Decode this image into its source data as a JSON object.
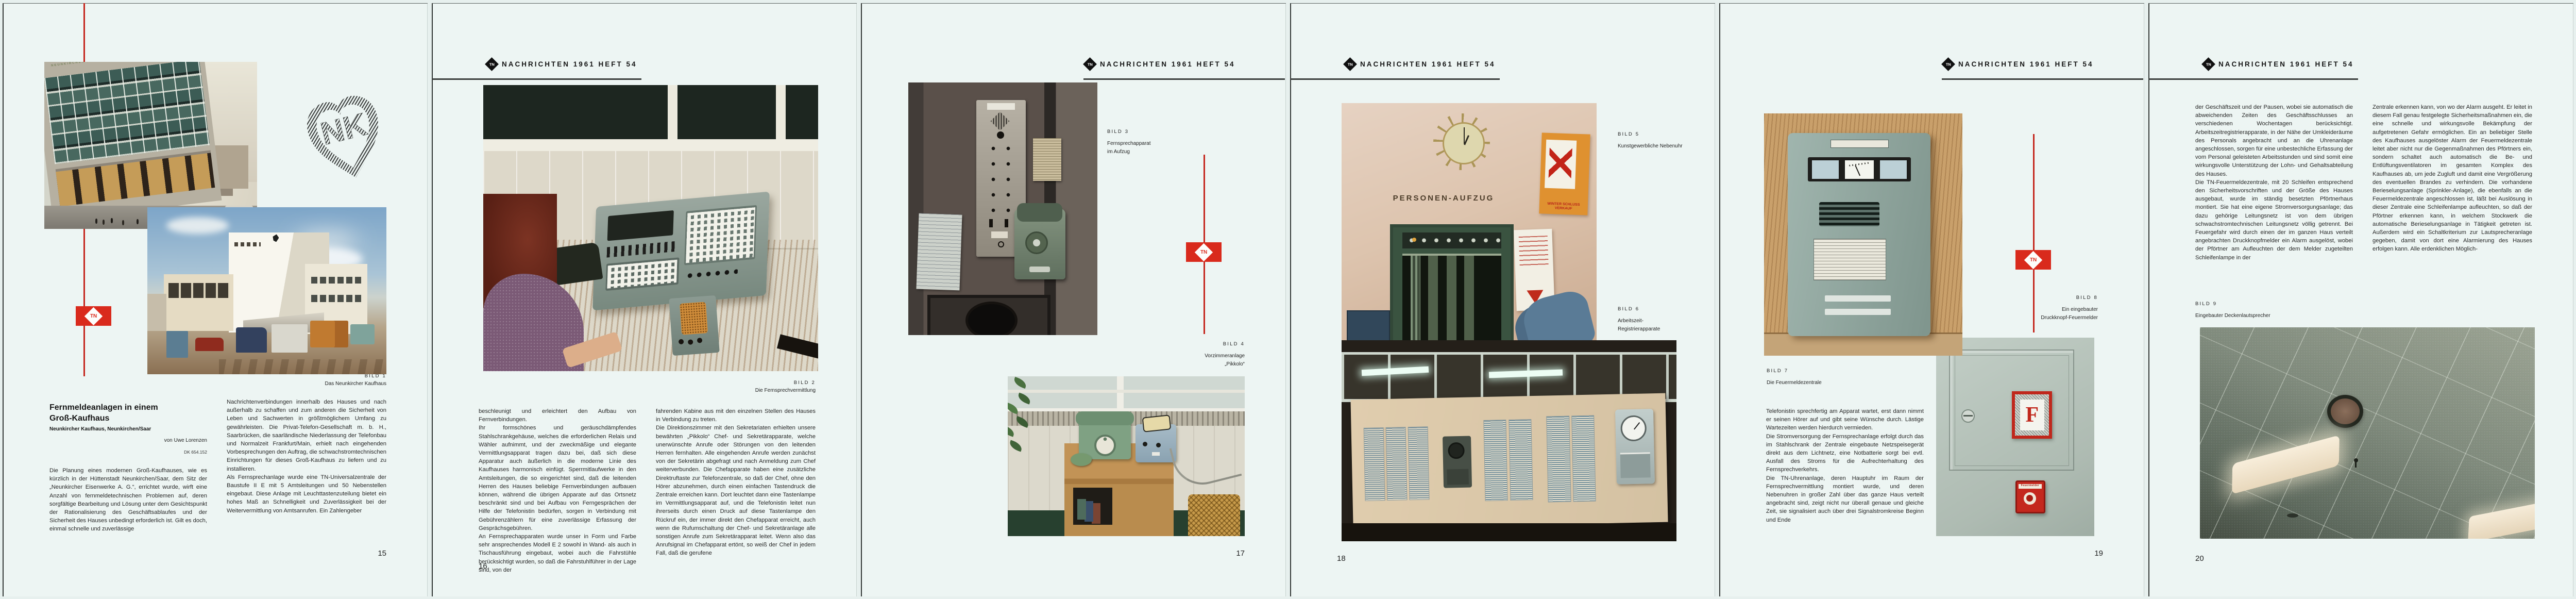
{
  "publication": {
    "header": "NACHRICHTEN 1961 HEFT 54",
    "logo_monogram": "TN",
    "accent_red": "#c4251c",
    "paper_color": "#edf5f3"
  },
  "sheets": [
    {
      "page_number": "15",
      "emblem_letters": "NK",
      "article": {
        "title_line1": "Fernmeldeanlagen in einem",
        "title_line2": "Groß-Kaufhaus",
        "subtitle": "Neunkircher Kaufhaus, Neunkirchen/Saar",
        "byline": "von Uwe Lorenzen",
        "dk": "DK 654.152"
      },
      "captions": {
        "bild1": {
          "label": "BILD 1",
          "line": "Das Neunkircher Kaufhaus"
        }
      },
      "photo_texts": {
        "roof_sign": "NEUNKIRCHER KAUFHAUS"
      },
      "columns": {
        "left": [
          "Die Planung eines modernen Groß-Kaufhauses, wie es kürzlich in der Hüttenstadt Neunkirchen/Saar, dem Sitz der „Neunkircher Eisenwerke A. G.“, errichtet wurde, wirft eine Anzahl von fernmeldetechnischen Problemen auf, deren sorgfältige Bearbeitung und Lösung unter dem Gesichtspunkt der Rationalisierung des Geschäftsablaufes und der Sicherheit des Hauses unbedingt erforderlich ist. Gilt es doch, einmal schnelle und zuverlässige"
        ],
        "right": [
          "Nachrichtenverbindungen innerhalb des Hauses und nach außerhalb zu schaffen und zum anderen die Sicherheit von Leben und Sachwerten in größtmöglichem Umfang zu gewährleisten. Die Privat-Telefon-Gesellschaft m. b. H., Saarbrücken, die saarländische Niederlassung der Telefonbau und Normalzeit Frankfurt/Main, erhielt nach eingehenden Vorbesprechungen den Auftrag, die schwachstromtechnischen Einrichtungen für dieses Groß-Kaufhaus zu liefern und zu installieren.",
          "Als Fernsprechanlage wurde eine TN-Universalzentrale der Baustufe II E mit 5 Amtsleitungen und 50 Nebenstellen eingebaut. Diese Anlage mit Leuchttastenzuteilung bietet ein hohes Maß an Schnelligkeit und Zuverlässigkeit bei der Weitervermittlung von Amtsanrufen. Ein Zahlengeber"
        ]
      }
    },
    {
      "page_number": "16",
      "captions": {
        "bild2": {
          "label": "BILD 2",
          "line": "Die Fernsprechvermittlung"
        }
      },
      "columns": {
        "left": [
          "beschleunigt und erleichtert den Aufbau von Fernverbindungen.",
          "Ihr formschönes und geräuschdämpfendes Stahlschrankgehäuse, welches die erforderlichen Relais und Wähler aufnimmt, und der zweckmäßige und elegante Vermittlungsapparat tragen dazu bei, daß sich diese Apparatur auch äußerlich in die moderne Linie des Kaufhauses harmonisch einfügt. Sperrmitlaufwerke in den Amtsleitungen, die so eingerichtet sind, daß die leitenden Herren des Hauses beliebige Fernverbindungen aufbauen können, während die übrigen Apparate auf das Ortsnetz beschränkt sind und bei Aufbau von Ferngesprächen der Hilfe der Telefonistin bedürfen, sorgen in Verbindung mit Gebührenzählern für eine zuverlässige Erfassung der Gesprächsgebühren.",
          "An Fernsprechapparaten wurde unser in Form und Farbe sehr ansprechendes Modell E 2 sowohl in Wand- als auch in Tischausführung eingebaut, wobei auch die Fahrstühle berücksichtigt wurden, so daß die Fahrstuhlführer in der Lage sind, von der"
        ],
        "right": [
          "fahrenden Kabine aus mit den einzelnen Stellen des Hauses in Verbindung zu treten.",
          "Die Direktionszimmer mit den Sekretariaten erhielten unsere bewährten „Pikkolo“ Chef- und Sekretärapparate, welche unerwünschte Anrufe oder Störungen von den leitenden Herren fernhalten. Alle eingehenden Anrufe werden zunächst von der Sekretärin abgefragt und nach Anmeldung zum Chef weiterverbunden. Die Chefapparate haben eine zusätzliche Direktruftaste zur Telefonzentrale, so daß der Chef, ohne den Hörer abzunehmen, durch einen einfachen Tastendruck die Zentrale erreichen kann. Dort leuchtet dann eine Tastenlampe im Vermittlungsapparat auf, und die Telefonistin leitet nun ihrerseits durch einen Druck auf diese Tastenlampe den Rückruf ein, der immer direkt den Chefapparat erreicht, auch wenn die Rufumschaltung der Chef- und Sekretäranlage alle sonstigen Anrufe zum Sekretärapparat leitet. Wenn also das Anrufsignal im Chefapparat ertönt, so weiß der Chef in jedem Fall, daß die gerufene"
        ]
      }
    },
    {
      "page_number": "17",
      "captions": {
        "bild3": {
          "label": "BILD 3",
          "lines": [
            "Fernsprechapparat",
            "im Aufzug"
          ]
        },
        "bild4": {
          "label": "BILD 4",
          "lines": [
            "Vorzimmeranlage",
            "„Pikkolo“"
          ]
        }
      }
    },
    {
      "page_number": "18",
      "captions": {
        "bild5": {
          "label": "BILD 5",
          "lines": [
            "Kunstgewerbliche Nebenuhr"
          ]
        },
        "bild6": {
          "label": "BILD 6",
          "lines": [
            "Arbeitszeit-",
            "Registrierapparate"
          ]
        }
      },
      "photo_texts": {
        "aufzug_sign": "PERSONEN-AUFZUG",
        "poster": "WINTER SCHLUSS VERKAUF"
      }
    },
    {
      "page_number": "19",
      "captions": {
        "bild7": {
          "label": "BILD 7",
          "lines": [
            "Die Feuermeldezentrale"
          ]
        },
        "bild8": {
          "label": "BILD 8",
          "lines": [
            "Ein eingebauter",
            "Druckknopf-Feuermelder"
          ]
        }
      },
      "photo_texts": {
        "f": "F",
        "melder": "Feuermelder"
      },
      "columns": {
        "left": [
          "Telefonistin sprechfertig am Apparat wartet, erst dann nimmt er seinen Hörer auf und gibt seine Wünsche durch. Lästige Wartezeiten werden hierdurch vermieden.",
          "Die Stromversorgung der Fernsprechanlage erfolgt durch das im Stahlschrank der Zentrale eingebaute Netzspeisegerät direkt aus dem Lichtnetz, eine Notbatterie sorgt bei evtl. Ausfall des Stroms für die Aufrechterhaltung des Fernsprechverkehrs.",
          "Die TN-Uhrenanlage, deren Hauptuhr im Raum der Fernsprechvermittlung montiert wurde, und deren Nebenuhren in großer Zahl über das ganze Haus verteilt angebracht sind, zeigt nicht nur überall genaue und gleiche Zeit, sie signalisiert auch über drei Signalstromkreise Beginn und Ende"
        ]
      }
    },
    {
      "page_number": "20",
      "captions": {
        "bild9": {
          "label": "BILD 9",
          "lines": [
            "Eingebauter Deckenlautsprecher"
          ]
        }
      },
      "columns": {
        "left": [
          "der Geschäftszeit und der Pausen, wobei sie automatisch die abweichenden Zeiten des Geschäftsschlusses an verschiedenen Wochentagen berücksichtigt. Arbeitszeitregistrierapparate, in der Nähe der Umkleideräume des Personals angebracht und an die Uhrenanlage angeschlossen, sorgen für eine unbestechliche Erfassung der vom Personal geleisteten Arbeitsstunden und sind somit eine wirkungsvolle Unterstützung der Lohn- und Gehaltsabteilung des Hauses.",
          "Die TN-Feuermeldezentrale, mit 20 Schleifen entsprechend den Sicherheitsvorschriften und der Größe des Hauses ausgebaut, wurde im ständig besetzten Pförtnerhaus montiert. Sie hat eine eigene Stromversorgungsanlage; das dazu gehörige Leitungsnetz ist von dem übrigen schwachstromtechnischen Leitungsnetz völlig getrennt. Bei Feuergefahr wird durch einen der im ganzen Haus verteilt angebrachten Druckknopfmelder ein Alarm ausgelöst, wobei der Pförtner am Aufleuchten der dem Melder zugeteilten Schleifenlampe in der"
        ],
        "right": [
          "Zentrale erkennen kann, von wo der Alarm ausgeht. Er leitet in diesem Fall genau festgelegte Sicherheitsmaßnahmen ein, die eine schnelle und wirkungsvolle Bekämpfung der aufgetretenen Gefahr ermöglichen. Ein an beliebiger Stelle des Kaufhauses ausgelöster Alarm der Feuermeldezentrale leitet aber nicht nur die Gegenmaßnahmen des Pförtners ein, sondern schaltet auch automatisch die Be- und Entlüftungsventilatoren im gesamten Komplex des Kaufhauses ab, um jede Zugluft und damit eine Vergrößerung des eventuellen Brandes zu verhindern. Die vorhandene Berieselungsanlage (Sprinkler-Anlage), die ebenfalls an die Feuermeldezentrale angeschlossen ist, läßt bei Auslösung in dieser Zentrale eine Schleifenlampe aufleuchten, so daß der Pförtner erkennen kann, in welchem Stockwerk die automatische Berieselungsanlage in Tätigkeit getreten ist. Außerdem wird ein Schaltkriterium zur Lautsprecheranlage gegeben, damit von dort eine Alarmierung des Hauses erfolgen kann. Alle erdenklichen Möglich-"
        ]
      }
    },
    {
      "page_number": "21",
      "captions": {
        "bild10": {
          "label": "BILD 10",
          "lines": [
            "Wandlautsprecher",
            "der elektro-akustischen Rufanlage"
          ]
        }
      },
      "photo_texts": {
        "exit": "Ausgang",
        "smoke": "Rauchen nicht erlaubt",
        "glass1": "NUR",
        "glass2": "NOTAUSGANG",
        "number": "297"
      },
      "columns": {
        "left": [
          "keiten wurden berücksichtigt, um die Sicherheit des Hauses, des Publikums und des Personals bei Feuergefahr zu gewährleisten.",
          "Die elektro-akustische Rufanlage, in Zusammenarbeit mit der Firma Telefunken entwickelt, ist recht umfangreich. Sie umfaßt neben der Verstärkerzentrale über 100 im Hause verteilte Lautsprecher, die z. T. in die Decken eingebaut wurden. Anschlüsse für Mikrofone in den verschiedenen Abteilungen des Hauses und die Möglichkeit, in einzelnen Abteilungen, getrennt von den anderen, Sonderprogramme mittels eines Übertragungswagens aussenden zu können, sind ebenfalls vorhanden. Mikrofone mit der Möglichkeit der Sammelschaltung (Kommandoschaltung) wurden in der Telefonzentrale und bei den leitenden Direktoren installiert. Über diese Mikrofone können alle Lautsprecher angesprochen werden, gleichgültig, ob diese in einzelnen Abteilungen abgeschaltet sind oder ein Einzelprogramm abstrahlen. Auch die von der Hauptuhr der Uhrenanlage abgegebenen"
        ],
        "right": [
          "Signale für Beginn und Ende der Geschäftszeit und der Pausen werden durch eine Gongschlageinrichtung in Verbindung mit der Verstärkerzentrale über die Lautsprecher ausgestrahlt. Auch die Signalgabe bei Fernalarm erfolgt von der Feuermeldeanlage her über die Lautsprecheranlage. In diesem Fall werden alle sonstigen Programme der elektro-akustischen Rufanlage automatisch abgeschaltet (Vorrangschaltung).",
          "An verschiedenen Stellen des Hauses, besonders jedoch in den Verkaufsabteilungen für Rundfunk- und Fernsehgeräte und in Schaufenstern können Rundfunk- und Fernsehgeräte über Spezialsteckdosen an eine umfangreiche Antennenanlage mit den Wellenbereichen Lang - Mittel - Kurz - UKW und Fernsehen angeschlossen werden, so daß die Programme einwandfrei empfangen werden können. Die Antennenverstärker wurden neben der Telefonzentrale montiert, so daß sie leicht zugänglich sind und ohne Schwierigkeit gewartet werden können."
        ]
      }
    },
    {
      "page_number": "22",
      "captions": {
        "bild11": {
          "label": "BILD 11",
          "lines": [
            "Rapidofon-Hausfernsprecher",
            "in der Kühlvitrine"
          ]
        }
      },
      "photo_texts": {
        "taps": [
          "Coca-Cola",
          "Fanta",
          "Coca-Cola"
        ]
      },
      "columns": {
        "left": [
          "Kühlvitrinen in der Lebensmittelabteilung des Kaufhauses nehmen leichtverderbliche Lebensmittel auf. Es lag nahe, hier durch eine besondere Überwachungseinrichtung ständig die Temperaturen in den Vitrinen kontrollieren zu lassen, damit Abweichungen von der vorgeschriebenen Temperaturhöhe sofort signalisiert und Abhilfemaßnahmen eingeleitet werden können. Mit Thermoschaltern und Anzeigetablos, welche sowohl optisch über Lampen als auch akustisch über Summer Temperaturabweichungen signalisieren, werden der einwandfreie Betrieb der Kühlaggregate überwacht und Störungen für jede Kühlvitrine getrennt angezeigt.",
          "Eine automatische Verkehrssignal-Anlage für ein- und ausfahrende Kraftfahrzeuge regelt den Verkehr auf der einspurigen Zufahrt zum Parkplatz. Dabei wird die erforderliche Steuerung der Lichtsignale von den Kraftfahrzeugen durch Überfahren einer Bodenschwelle selbst vorgenommen. Diese Bodenschwellen betätigen Kontakte, welche über"
        ],
        "right": [
          "eine Relaisschaltung die Farben rot, gelb oder grün in den Verkehrsampeln zur Einschaltung bringen. Eine sinnreiche Verzögerungsschaltung sorgt dafür, daß ein noch in Zu- oder Abfahrt befindliches Kraftfahrzeug rechtzeitig die einbahnige Wegstrecke verlassen kann, bevor das wartende Fahrzeug grünes Signal erhält.",
          "Naturgemäß konnte im begrenzten Rahmen dieser Abhandlung nur in großen Zügen auf die einzelnen fernmeldetechnischen Anlagen eingegangen werden, jedoch wollte die vorliegende Beschreibung einen Überblick über den vielseitigen Anwendungsbereich von Fernmeldeanlagen geben und damit deren Bedeutung für den rationellen Betriebsablauf in einem Kaufhaus aufzeigen."
        ]
      }
    }
  ]
}
